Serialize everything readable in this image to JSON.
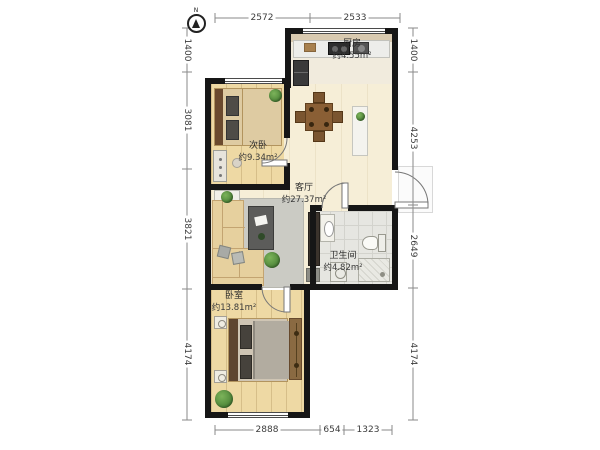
{
  "compass": {
    "label": "N"
  },
  "rooms": {
    "kitchen": {
      "name": "厨房",
      "area": "约4.55m²"
    },
    "second_bedroom": {
      "name": "次卧",
      "area": "约9.34m²"
    },
    "living": {
      "name": "客厅",
      "area": "约27.37m²"
    },
    "bathroom": {
      "name": "卫生间",
      "area": "约4.82m²"
    },
    "master_bedroom": {
      "name": "卧室",
      "area": "约13.81m²"
    }
  },
  "dimensions": {
    "top": [
      "2572",
      "2533"
    ],
    "left": [
      "1400",
      "3081",
      "3821",
      "4174"
    ],
    "right": [
      "1400",
      "4253",
      "2649",
      "4174"
    ],
    "bottom": [
      "2888",
      "654",
      "1323"
    ]
  },
  "colors": {
    "wall": "#161616",
    "wood_floor": "#eed9a4",
    "living_floor": "#f6eed7",
    "tile_floor": "#e6e6e1",
    "plant_green": "#4e8f3a",
    "dim_text": "#3c3c3c"
  }
}
